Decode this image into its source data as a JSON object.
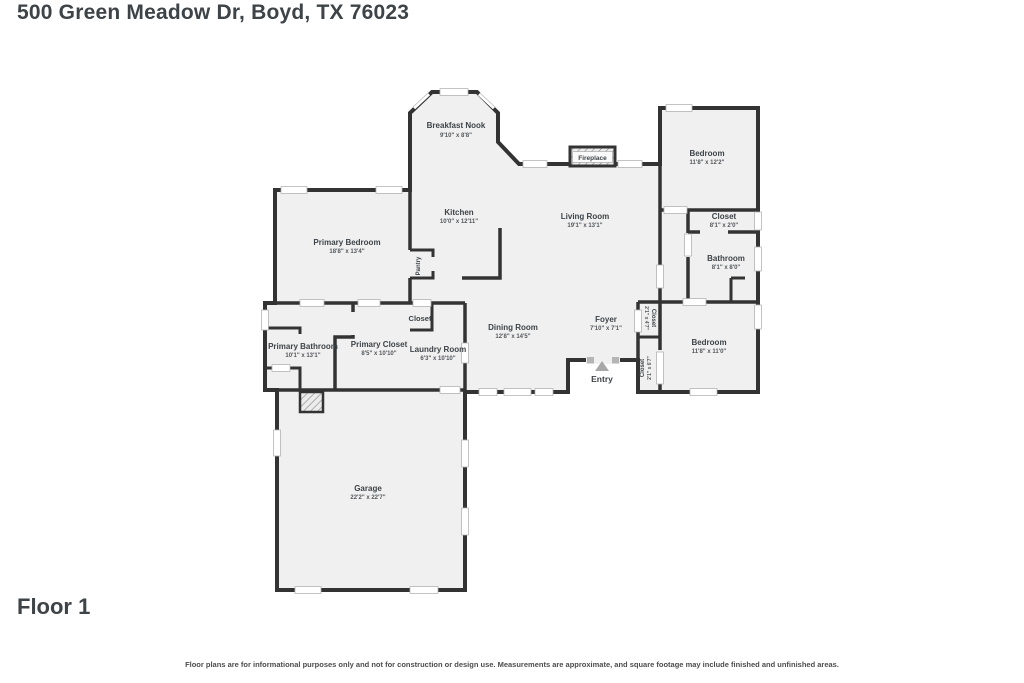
{
  "page": {
    "title": "500 Green Meadow Dr, Boyd, TX 76023",
    "floor_label": "Floor 1",
    "disclaimer": "Floor plans are for informational purposes only and not for construction or design use. Measurements are approximate, and square footage may include finished and unfinished areas."
  },
  "colors": {
    "wall": "#333333",
    "floor": "#f0f0f0",
    "title_text": "#3e4347",
    "dim_text": "#54575b",
    "entry_arrow": "#a8a8a8"
  },
  "rooms": [
    {
      "name": "Breakfast Nook",
      "dims": "9'10\" x 8'8\""
    },
    {
      "name": "Bedroom",
      "dims": "11'8\" x 12'2\""
    },
    {
      "name": "Kitchen",
      "dims": "10'0\" x 12'11\""
    },
    {
      "name": "Living Room",
      "dims": "19'1\" x 13'1\""
    },
    {
      "name": "Closet",
      "dims": "8'1\" x 2'0\""
    },
    {
      "name": "Bathroom",
      "dims": "8'1\" x 8'0\""
    },
    {
      "name": "Primary Bedroom",
      "dims": "18'8\" x 13'4\""
    },
    {
      "name": "Dining Room",
      "dims": "12'8\" x 14'5\""
    },
    {
      "name": "Foyer",
      "dims": "7'10\" x 7'1\""
    },
    {
      "name": "Bedroom",
      "dims": "11'8\" x 11'0\""
    },
    {
      "name": "Primary Bathroom",
      "dims": "10'1\" x 13'1\""
    },
    {
      "name": "Primary Closet",
      "dims": "8'5\" x 10'10\""
    },
    {
      "name": "Laundry Room",
      "dims": "6'3\" x 10'10\""
    },
    {
      "name": "Garage",
      "dims": "22'2\" x 22'7\""
    },
    {
      "name": "Closet",
      "dims": "2'1\" x 4'7\""
    },
    {
      "name": "Closet",
      "dims": "2'1\" x 6'7\""
    }
  ],
  "features": {
    "fireplace": "Fireplace",
    "pantry": "Pantry",
    "closet_small": "Closet",
    "entry": "Entry"
  }
}
